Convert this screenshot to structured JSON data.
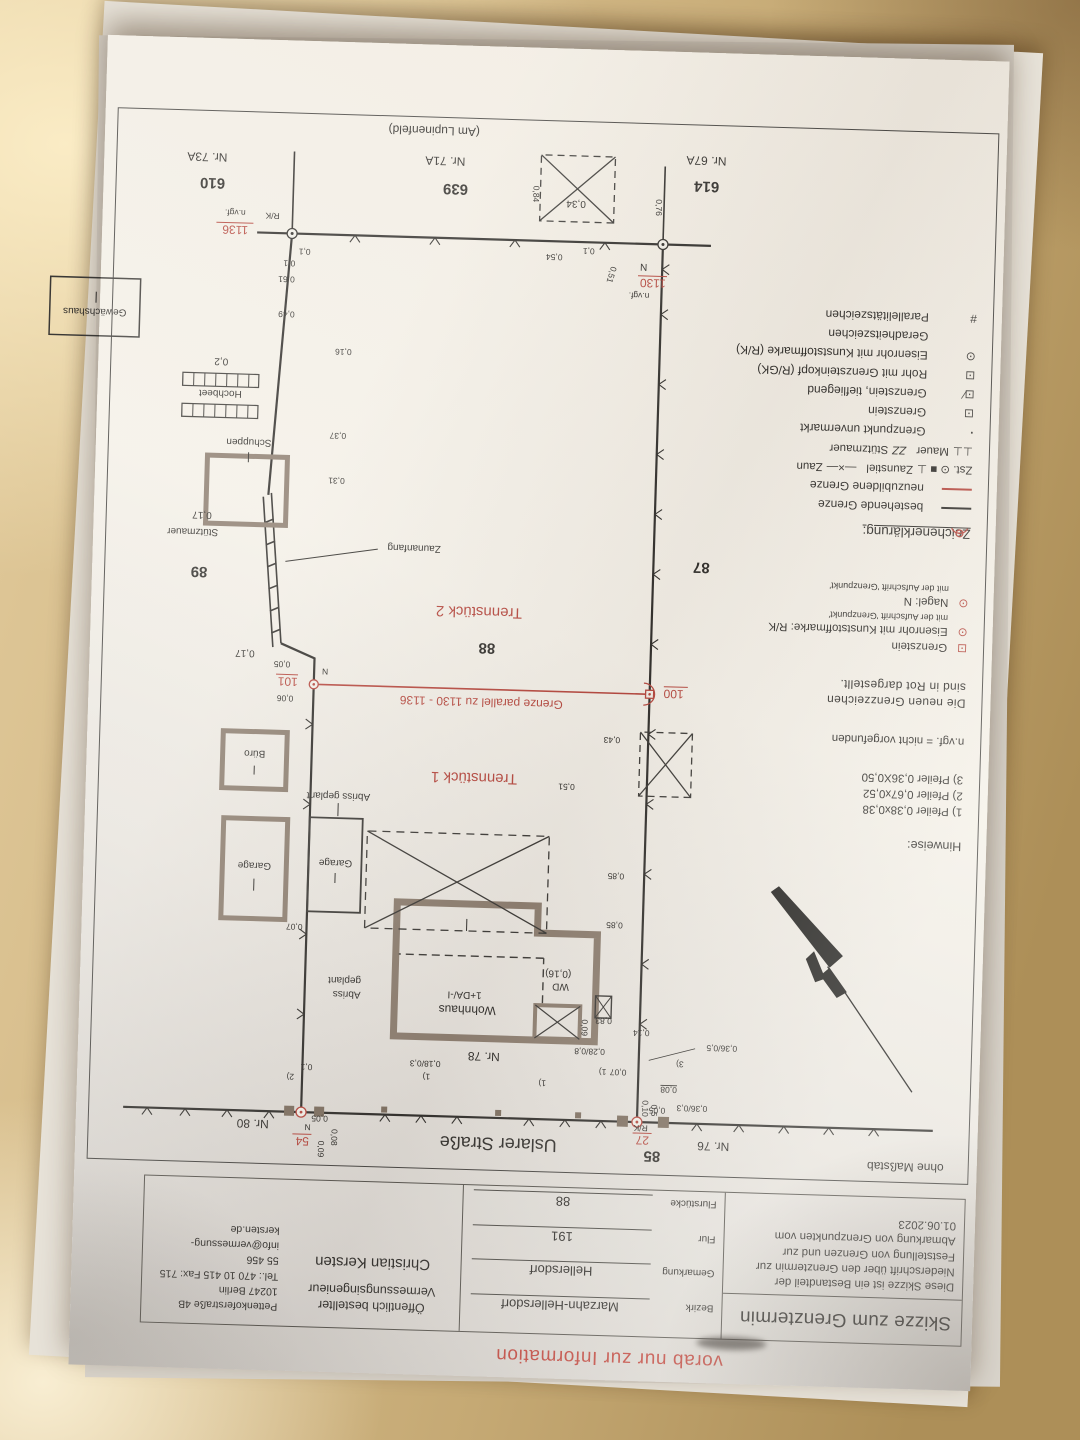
{
  "stamp": "vorab nur zur Information",
  "frame_note": "ohne Maßstab",
  "colors": {
    "red": "#b5453c",
    "ink": "#2e2c29",
    "wall": "#8c7d6f"
  },
  "title_block": {
    "title": "Skizze zum Grenztermin",
    "description": "Diese Skizze ist ein Bestandteil der Niederschrift über den Grenztermin zur Feststellung von Grenzen und zur Abmarkung von Grenzpunkten vom 01.06.2023",
    "fields": [
      {
        "label": "Bezirk",
        "value": "Marzahn-Hellersdorf"
      },
      {
        "label": "Gemarkung",
        "value": "Hellersdorf"
      },
      {
        "label": "Flur",
        "value": "191"
      },
      {
        "label": "Flurstücke",
        "value": "88"
      }
    ],
    "surveyor": {
      "line1": "Öffentlich bestellter",
      "line2": "Vermessungsingenieur",
      "name": "Christian Kersten"
    },
    "address": {
      "street": "Pettenkoferstraße 4B",
      "city": "10247 Berlin",
      "phone": "Tel.: 470 10 415  Fax: 715 55 456",
      "email": "info@vermessung-kersten.de"
    }
  },
  "notes": {
    "heading": "Hinweise:",
    "item1": "1) Pfeiler 0,38x0,38",
    "item2": "2) Pfeiler 0,67x0,52",
    "item3": "3) Pfeiler 0,36X0,50",
    "abbr": "n.vgf. = nicht vorgefunden",
    "red1": "Die  neuen  Grenzzeichen",
    "red2": "sind in Rot dargestellt."
  },
  "marker_defs": {
    "grenzstein_sym": "⊡",
    "grenzstein": "Grenzstein",
    "eisenrohr_sym": "⊙",
    "eisenrohr": "Eisenrohr mit Kunststoffmarke: R/K",
    "eisenrohr_sub": "mit der Aufschrift 'Grenzpunkt'",
    "nagel_sym": "⊙",
    "nagel": "Nagel: N",
    "nagel_sub": "mit der Aufschrift 'Grenzpunkt'"
  },
  "legend": {
    "heading": "Zeichenerklärung:",
    "bestehende": "bestehende Grenze",
    "neuzubildene": "neuzubildene Grenze",
    "zst_prefix": "Zst. ⊙ ■ ⊥",
    "zaunstiel": "Zaunstiel",
    "zaun_sym": "—×—",
    "zaun": "Zaun",
    "mauer_sym": "⊥⊥",
    "mauer": "Mauer",
    "stuetz_sym": "ΖΖ",
    "stuetzmauer": "Stützmauer",
    "unvermarkt_sym": "·",
    "unvermarkt": "Grenzpunkt unvermarkt",
    "grenzstein_sym": "⊡",
    "grenzstein": "Grenzstein",
    "tief_sym": "⊡∕",
    "tief": "Grenzstein, tiefliegend",
    "rohr_sym": "⊡",
    "rohr": "Rohr mit Grenzsteinkopf (R/GK)",
    "eisenrohr_sym": "⊙",
    "eisenrohr": "Eisenrohr mit Kunststoffmarke (R/K)",
    "gerad": "Geradheitszeichen",
    "parallel_sym": "#",
    "parallel": "Parallelitätszeichen"
  },
  "plan": {
    "street_top": "Uslarer Straße",
    "street_bottom": "(Am Lupinenfeld)",
    "p85": "85",
    "nr76": "Nr. 76",
    "nr78": "Nr. 78",
    "nr80": "Nr. 80",
    "f87": "87",
    "f88": "88",
    "f89": "89",
    "f614": "614",
    "f639": "639",
    "f610": "610",
    "nr67a": "Nr. 67A",
    "nr71a": "Nr. 71A",
    "nr73a": "Nr. 73A",
    "tren1": "Trennstück 1",
    "tren2": "Trennstück 2",
    "red_line_label": "Grenze parallel zu 1130 - 1136",
    "pt27": "27",
    "pt54": "54",
    "pt100": "100",
    "pt101": "101",
    "pt1130": "1130",
    "pt1136": "1136",
    "rk27": "R/K",
    "rk1136": "R/K",
    "n54": "N",
    "n101": "N",
    "n1130": "N",
    "nvgf1130": "n.vgf.",
    "nvgf1136": "n.vgf.",
    "wohnhaus": "Wohnhaus",
    "wohnhaus_storeys": "1+DA/-I",
    "wd": "WD",
    "wd_val": "(0,16)",
    "garage1": "Garage",
    "garage2": "Garage",
    "buero": "Büro",
    "schuppen": "Schuppen",
    "gewaechshaus": "Gewächshaus",
    "hochbeet": "Hochbeet",
    "stuetzmauer": "Stützmauer",
    "zaunanfang": "Zaunanfang",
    "abriss_a1": "Abriss",
    "abriss_a2": "geplant",
    "abriss_b": "Abriss geplant",
    "meas": {
      "m036_03": "0,36/0,3",
      "m036_05": "0,36/0,5",
      "m028_08": "0,28/0,8",
      "m018_03": "0,18/0,3",
      "m007": "0,07",
      "m014": "0,14",
      "m008a": "0,08",
      "m008b": "0,08",
      "m005a": "0,05",
      "m005b": "0,05",
      "m005c": "0,05",
      "m009a": "0,09",
      "m009b": "0,09",
      "m010a": "0,10",
      "m05": "0,5",
      "m083": "0,83",
      "m085a": "0,85",
      "m085b": "0,85",
      "m051a": "0,51",
      "m051b": "0,51",
      "m043": "0,43",
      "m006": "0,06",
      "m017a": "0,17",
      "m017b": "0,17",
      "m031": "0,31",
      "m016": "0,16",
      "m037": "0,37",
      "m02": "0,2",
      "m049": "0,49",
      "m061": "0,61",
      "m054": "0,54",
      "m01a": "0,1",
      "m01b": "0,1",
      "m01c": "0,1",
      "m01d": "0,1",
      "m034": "0,34",
      "m084": "0,84",
      "m076": "0,76",
      "ref1a": "1)",
      "ref1b": "1)",
      "ref1c": "1)",
      "ref2": "2)",
      "ref3": "3)"
    }
  }
}
